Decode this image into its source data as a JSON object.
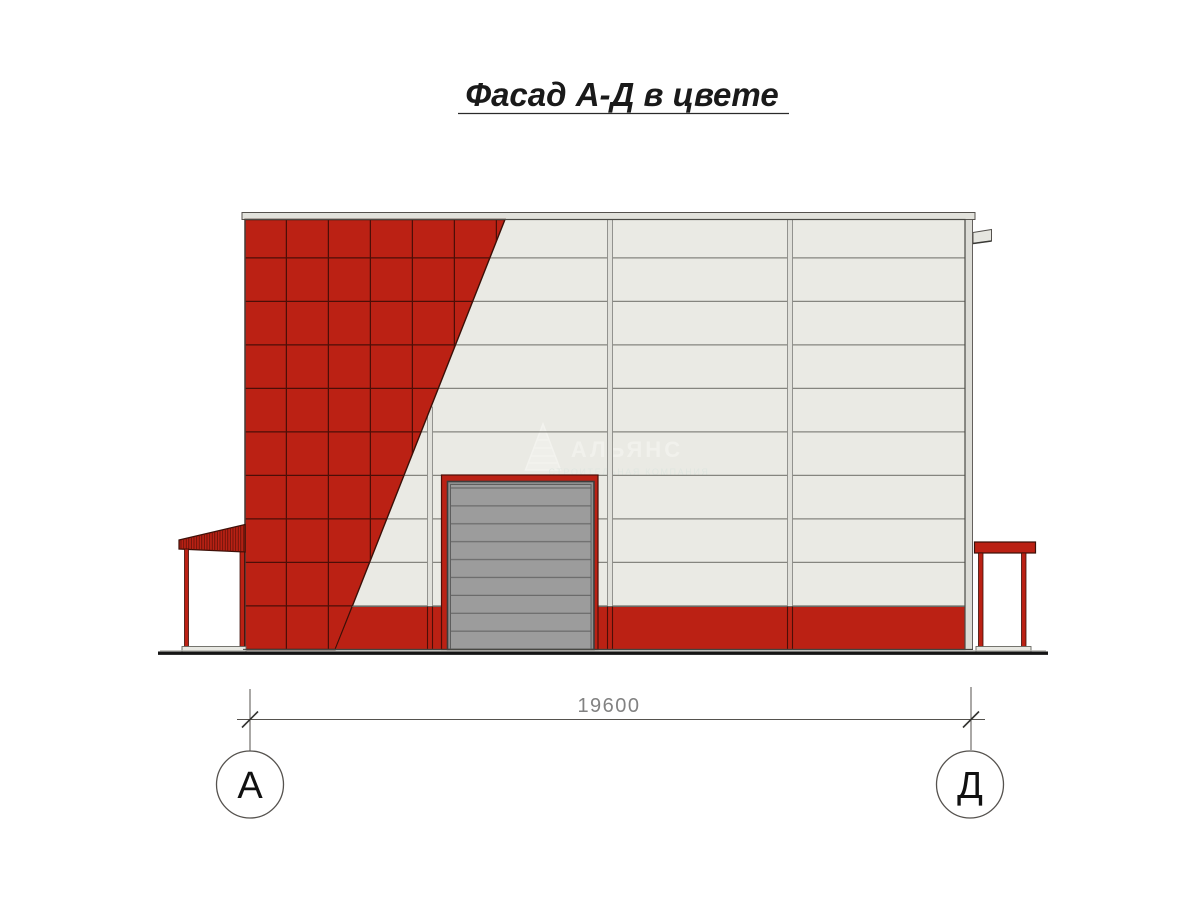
{
  "title": {
    "text": "Фасад А-Д в цвете"
  },
  "watermark": {
    "name": "АЛЬЯНС",
    "subtitle": "СТРОИТЕЛЬНАЯ КОМПАНИЯ",
    "logo": "pyramid-icon"
  },
  "dimension": {
    "value": "19600"
  },
  "axes": {
    "left": "А",
    "right": "Д"
  },
  "colors": {
    "facade_red": "#bb2114",
    "tile_joint": "#4d0e07",
    "panel_white": "#eaeae4",
    "panel_joint": "#85857f",
    "trim_gray": "#e2e2dc",
    "door_gray": "#9c9c9c",
    "door_slat_line": "#6b6b6b",
    "door_border": "#3d3d3d",
    "ground": "#151515",
    "outline_dark": "#3a1008"
  }
}
